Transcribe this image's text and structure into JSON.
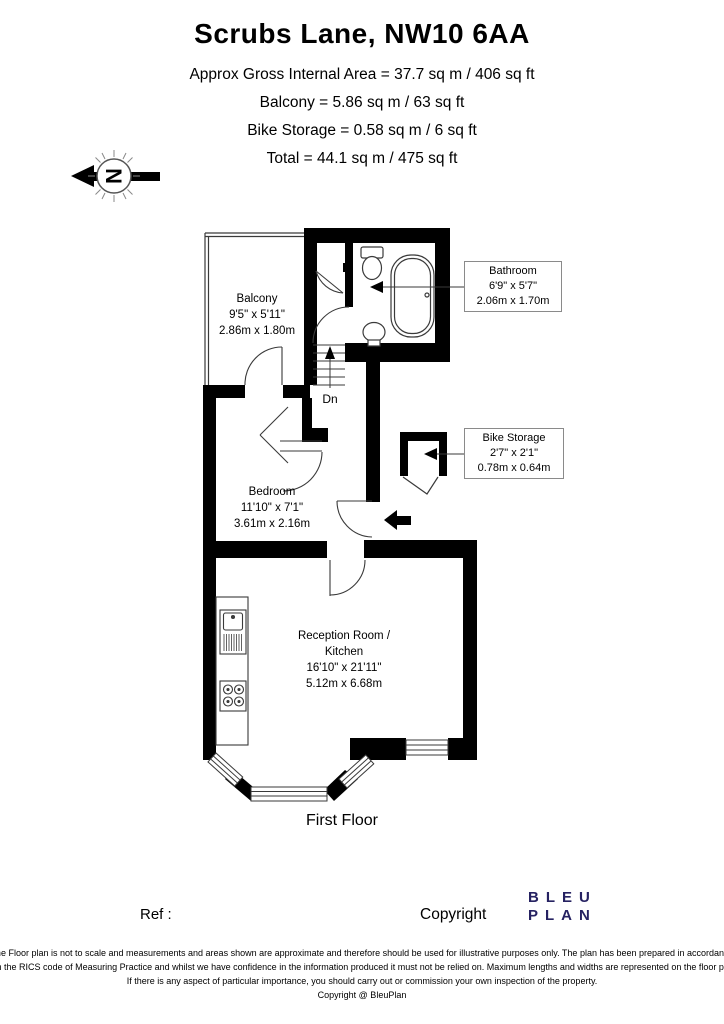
{
  "header": {
    "title": "Scrubs Lane, NW10 6AA",
    "line1": "Approx Gross Internal Area = 37.7 sq m / 406 sq ft",
    "line2": "Balcony = 5.86 sq m / 63 sq ft",
    "line3": "Bike Storage = 0.58 sq m / 6 sq ft",
    "line4": "Total = 44.1 sq m / 475 sq ft"
  },
  "compass": {
    "letter": "N"
  },
  "plan": {
    "balcony": {
      "name": "Balcony",
      "imperial": "9'5\" x 5'11\"",
      "metric": "2.86m x 1.80m"
    },
    "bathroom": {
      "name": "Bathroom",
      "imperial": "6'9\" x 5'7\"",
      "metric": "2.06m x 1.70m"
    },
    "bike": {
      "name": "Bike Storage",
      "imperial": "2'7\" x 2'1\"",
      "metric": "0.78m x 0.64m"
    },
    "bedroom": {
      "name": "Bedroom",
      "imperial": "11'10\" x 7'1\"",
      "metric": "3.61m x 2.16m"
    },
    "reception": {
      "name_line1": "Reception Room /",
      "name_line2": "Kitchen",
      "imperial": "16'10\" x 21'11\"",
      "metric": "5.12m x 6.68m"
    },
    "stairs_label": "Dn",
    "floor_label": "First Floor"
  },
  "footer": {
    "ref_label": "Ref  :",
    "copyright_label": "Copyright",
    "logo_line1": "BLEU",
    "logo_line2": "PLAN",
    "disclaimer1": "The Floor plan is not to scale and measurements and areas shown are approximate and therefore should be used for illustrative purposes only. The plan has been prepared in accordance",
    "disclaimer2": "with the RICS code of Measuring Practice and whilst we have confidence in the information produced it must not be relied on. Maximum lengths and widths are represented on the floor plan.",
    "disclaimer3": "If there is any aspect of particular importance, you should carry out or commission your own inspection of the property.",
    "disclaimer4": "Copyright @ BleuPlan"
  },
  "colors": {
    "wall": "#000000",
    "logo_navy": "#262262",
    "thin_line": "#3a3a3a"
  }
}
